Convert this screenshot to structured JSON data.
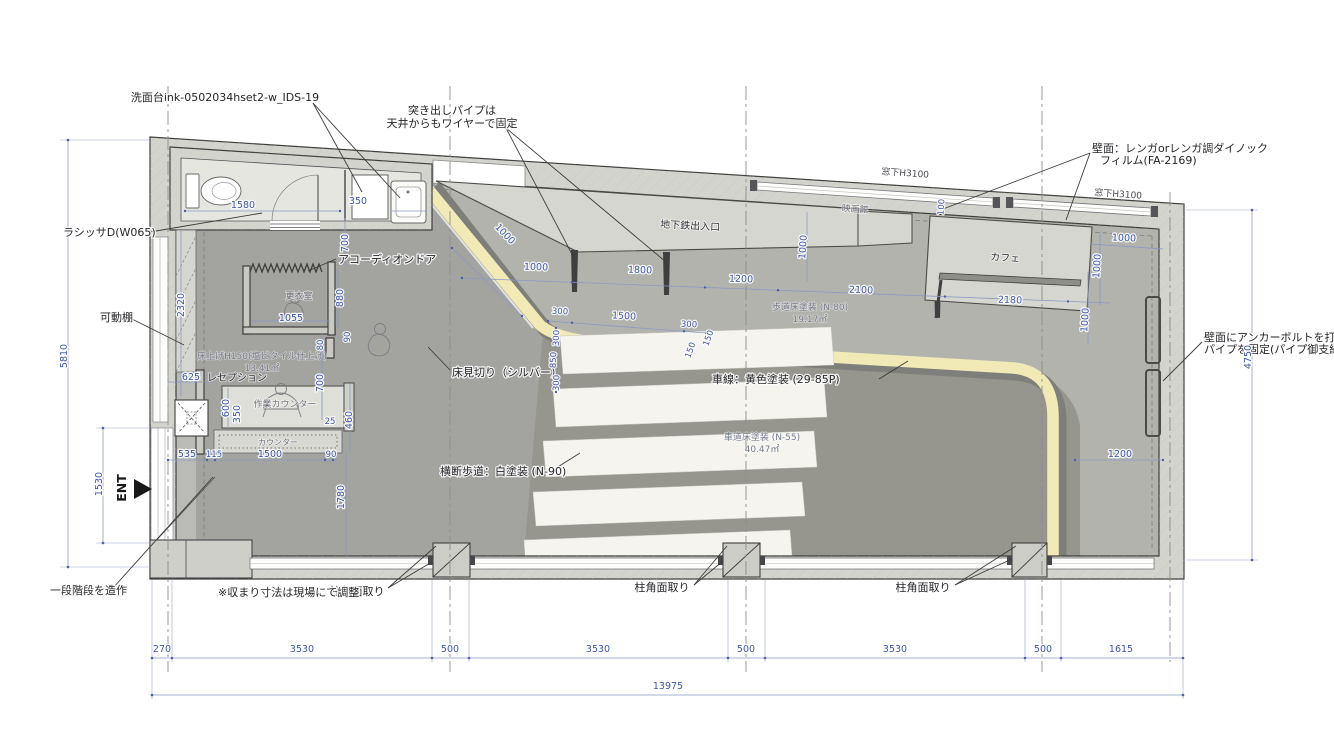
{
  "annotations": {
    "sink_model": "洗面台ink-0502034hset2-w_IDS-19",
    "pipe_note_line1": "突き出しパイプは",
    "pipe_note_line2": "天井からもワイヤーで固定",
    "wall_finish_line1": "壁面：レンガorレンガ調ダイノック",
    "wall_finish_line2": "フィルム(FA-2169)",
    "window_sill_a": "窓下H3100",
    "window_sill_b": "窓下H3100",
    "door_model": "ラシッサD(W065)",
    "movable_shelf": "可動棚",
    "accordion_door": "アコーディオンドア",
    "floor_divider": "床見切り（シルバー）",
    "lane_paint": "車線：黄色塗装 (29-85P)",
    "crosswalk_paint": "横断歩道：白塗装 (N-90)",
    "column_chamfer_1": "柱角面取り",
    "column_chamfer_2": "柱角面取り",
    "column_chamfer_3": "柱角面取り",
    "fit_note": "※収まり寸法は現場にて調整",
    "step_note": "一段階段を造作",
    "anchor_note_line1": "壁面にアンカーボルトを打ち、",
    "anchor_note_line2": "パイプを固定(パイプ御支給)",
    "entrance": "ENT"
  },
  "areas": {
    "subway_entrance": "地下鉄出入口",
    "cinema": "映画館",
    "cafe": "カフェ",
    "changing_room": "更衣室",
    "reception": "レセプション",
    "work_counter": "作業カウンター",
    "counter": "カウンター",
    "raised_floor_line1": "床上げH150(塩ビタイル仕上げ)",
    "raised_floor_line2": "13.41㎡",
    "sidewalk_line1": "歩道床塗装 (N-80)",
    "sidewalk_line2": "19.17㎡",
    "road_line1": "車道床塗装 (N-55)",
    "road_line2": "40.47㎡"
  },
  "dims": {
    "bottom_row": [
      "270",
      "3530",
      "500",
      "3530",
      "500",
      "3530",
      "500",
      "1615"
    ],
    "bottom_total": "13975",
    "v_5810": "5810",
    "v_1530": "1530",
    "v_2320": "2320",
    "v_4750": "4750",
    "toilet_1580": "1580",
    "toilet_350": "350",
    "sink_700": "700",
    "chg_1055": "1055",
    "chg_880": "880",
    "chg_90": "90",
    "chg_80": "80",
    "chg_700": "700",
    "rec_625": "625",
    "rec_600": "600",
    "rec_350": "350",
    "rec_25": "25",
    "rec_460": "460",
    "rec_535": "535",
    "rec_115": "115",
    "rec_1500": "1500",
    "rec_90": "90",
    "rec_1780": "1780",
    "sub_1000a": "1000",
    "sub_1000b": "1000",
    "sub_1800": "1800",
    "sub_1200": "1200",
    "sub_2100": "2100",
    "sub_1000c": "1000",
    "wall_100": "100",
    "cafe_2180": "2180",
    "cafe_1000a": "1000",
    "cafe_1000b": "1000",
    "cafe_1000c": "1000",
    "right_1200": "1200",
    "cw_300a": "300",
    "cw_1500": "1500",
    "cw_300b": "300",
    "cw_300c": "300",
    "cw_850": "850",
    "cw_300d": "300",
    "cw_150a": "150",
    "cw_150b": "150"
  },
  "colors": {
    "wall": "#d4d4ce",
    "sidewalk": "#b3b3ae",
    "road": "#96968f",
    "shop_floor": "#a3a3a0",
    "lane_yellow": "#f1eab6",
    "lane_shadow": "#7e7e7a",
    "crosswalk_white": "#f5f4ef",
    "dim_blue": "#3d56a6"
  }
}
